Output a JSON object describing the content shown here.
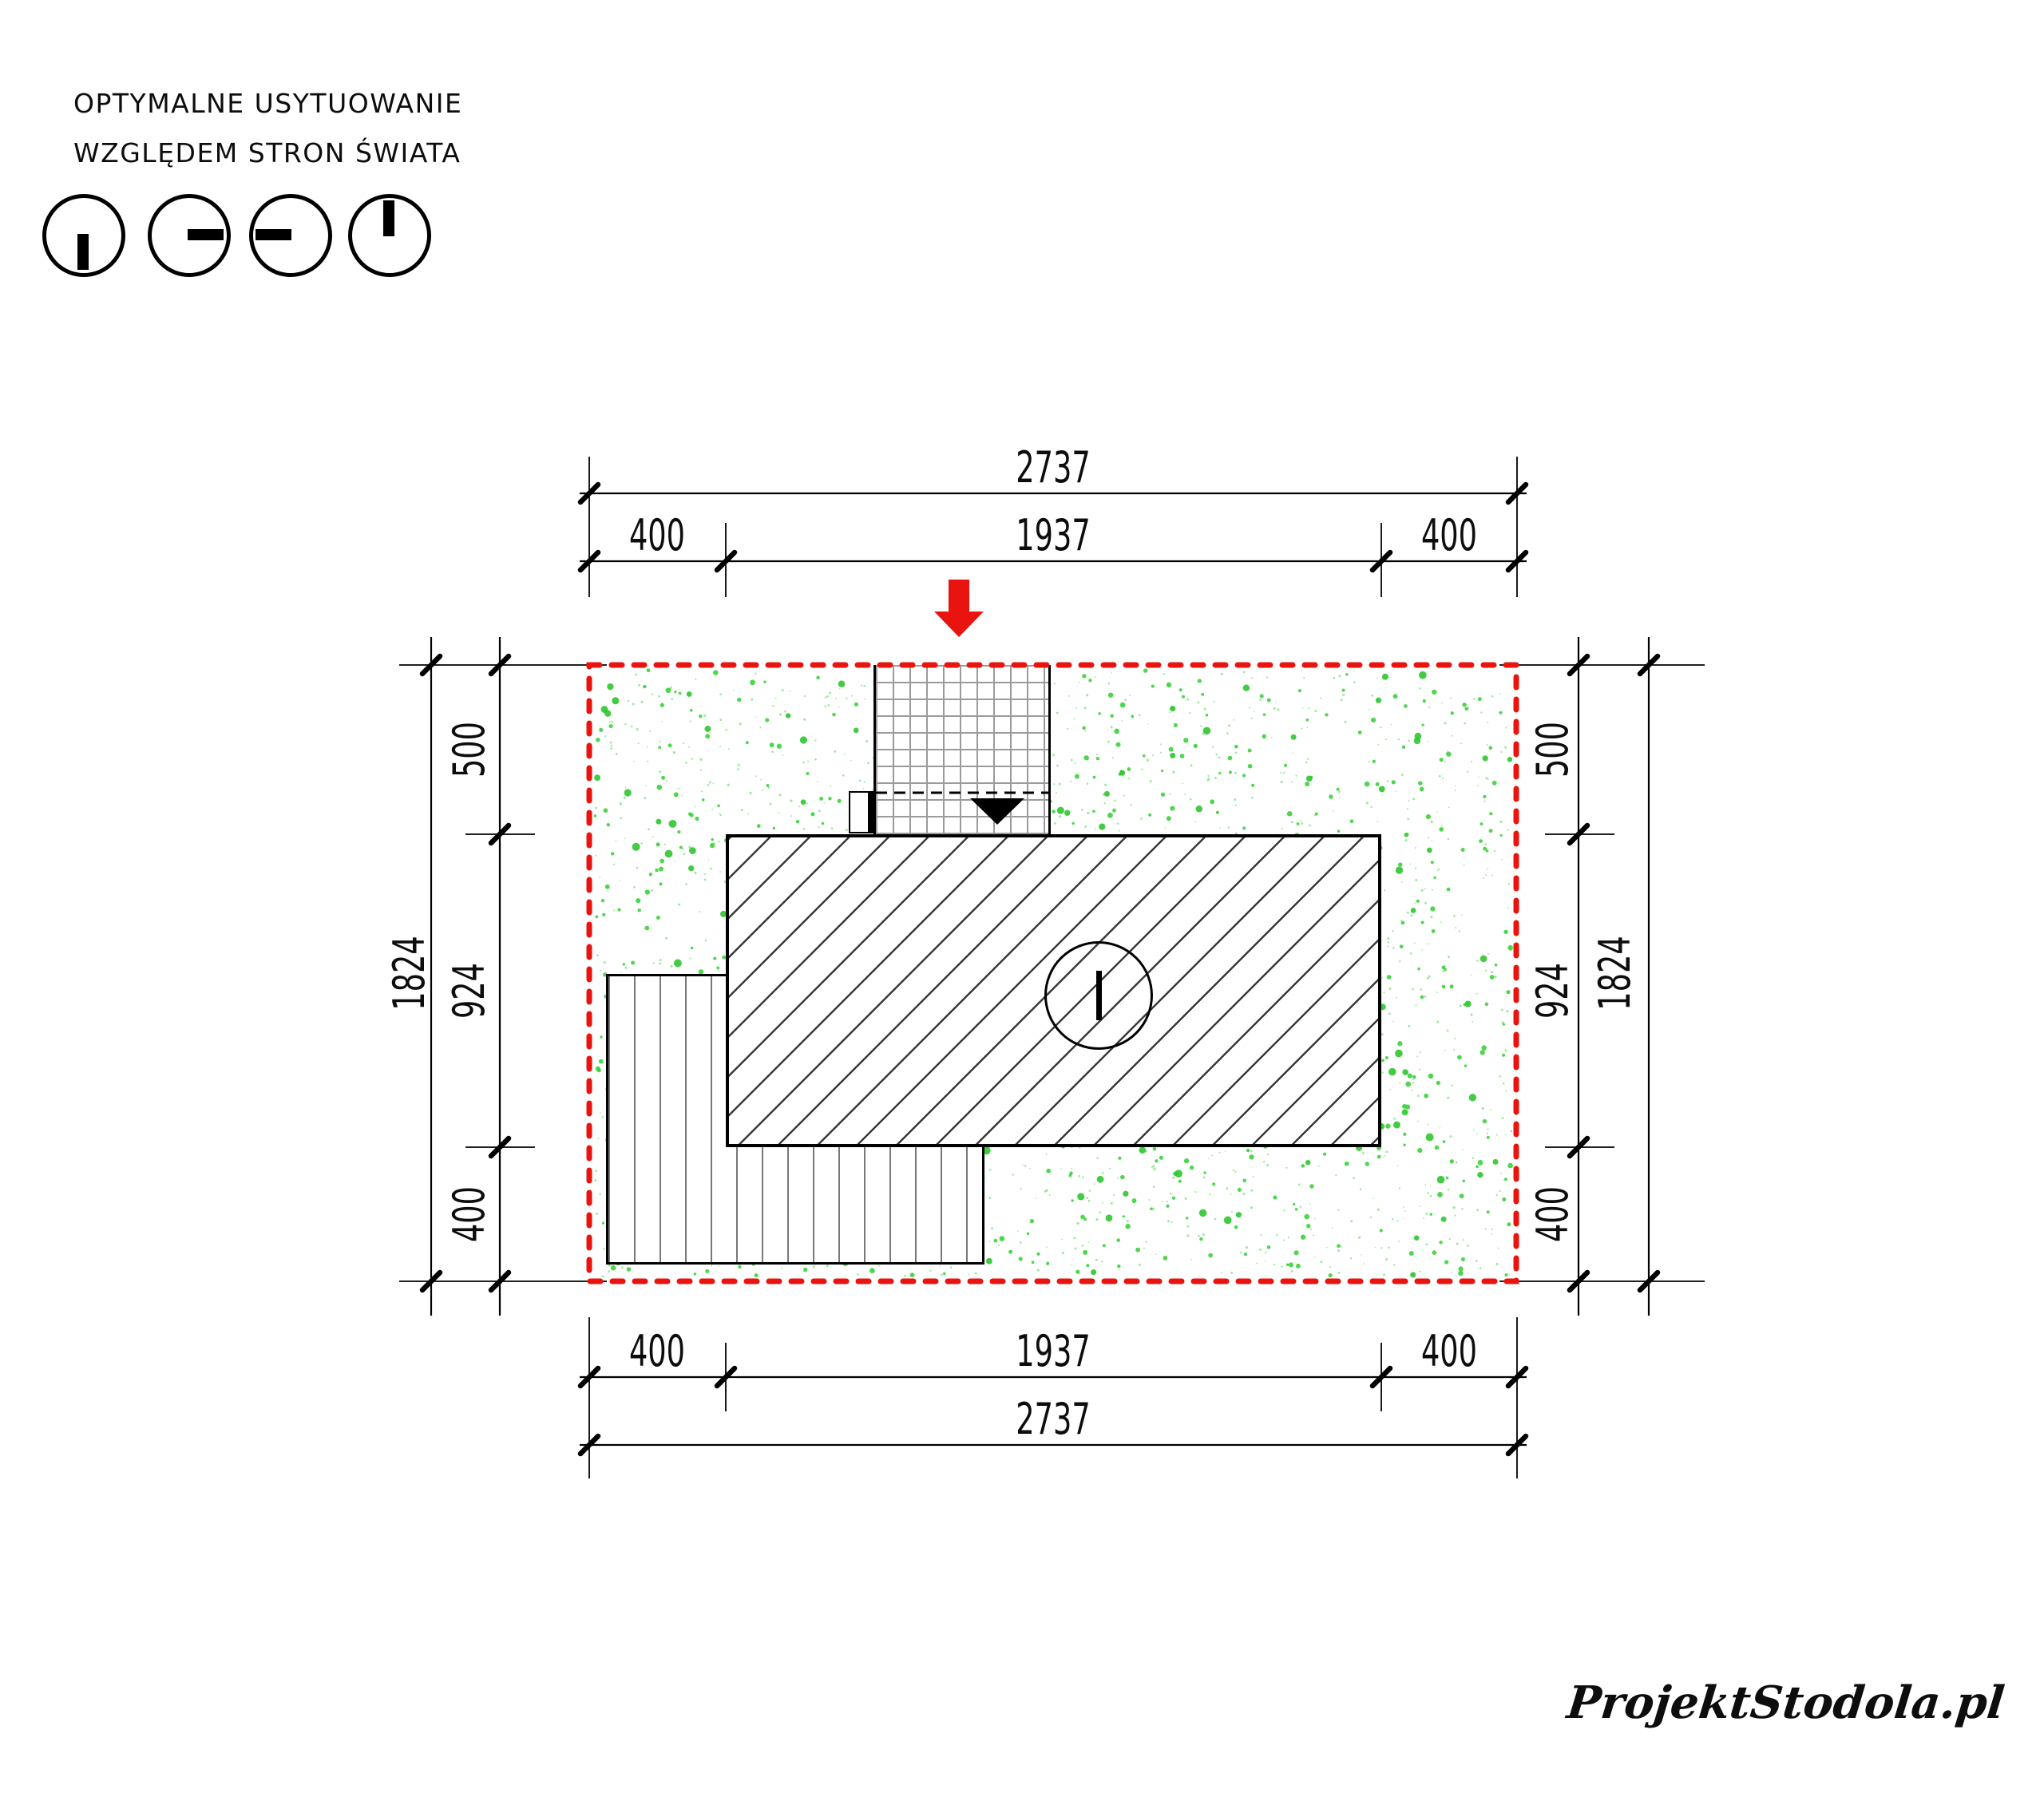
{
  "header": {
    "line1": "OPTYMALNE USYTUOWANIE",
    "line2": "WZGLĘDEM STRON ŚWIATA"
  },
  "compass_icons": [
    "south",
    "east",
    "west",
    "north"
  ],
  "dimensions": {
    "top": {
      "overall": "2737",
      "left_margin": "400",
      "building": "1937",
      "right_margin": "400"
    },
    "bottom": {
      "left_margin": "400",
      "building": "1937",
      "right_margin": "400",
      "overall": "2737"
    },
    "left": {
      "overall": "1824",
      "top_margin": "500",
      "building": "924",
      "bottom_margin": "400"
    },
    "right": {
      "top_margin": "500",
      "building": "924",
      "bottom_margin": "400",
      "overall": "1824"
    }
  },
  "colors": {
    "boundary_red": "#e9140f",
    "arrow_red": "#e9140f",
    "lawn_speckle_strong": "#3bd13b",
    "lawn_speckle_mid": "#2fc52f",
    "lawn_speckle_light": "#98e798",
    "paving_grid_gray": "#9b9b9b",
    "stripe_gray": "#787878",
    "line_black": "#000000"
  },
  "watermark": {
    "logo": "ProjektStodola.pl"
  }
}
